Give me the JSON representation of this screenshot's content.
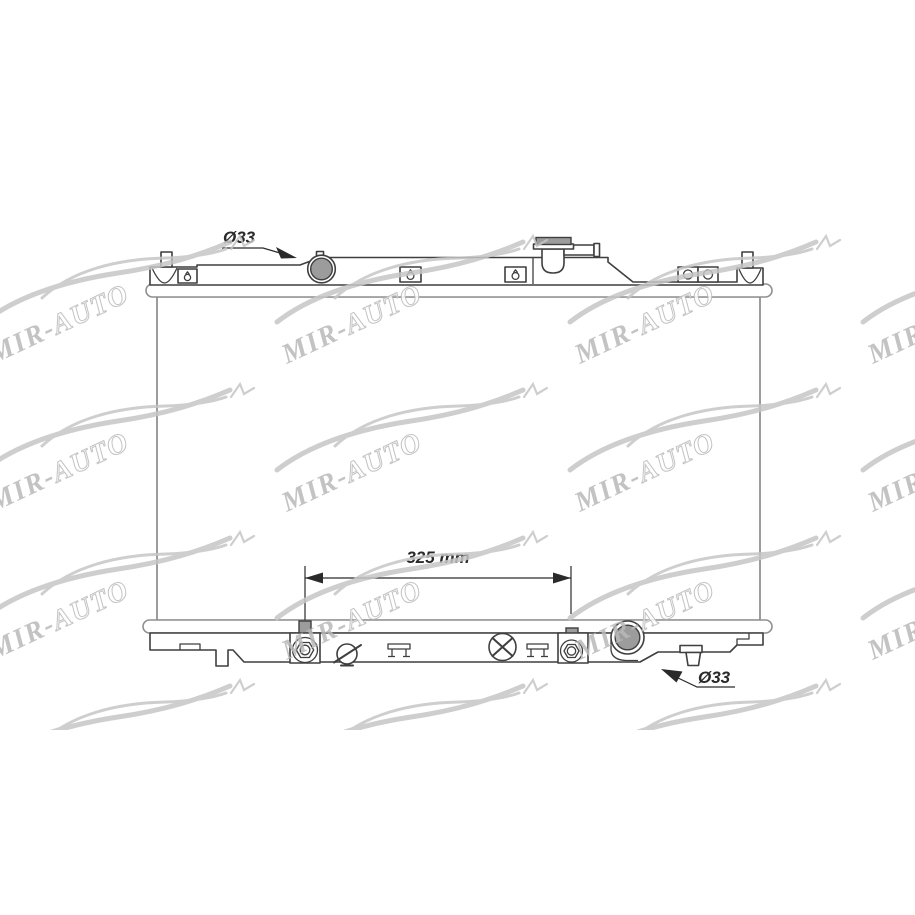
{
  "labels": {
    "inlet_diameter": "Ø33",
    "pipe_distance": "325 mm",
    "outlet_diameter": "Ø33"
  },
  "watermark": {
    "brand_first": "MIR-",
    "brand_second": "AUTO"
  },
  "colors": {
    "line": "#3f3f3f",
    "bar": "#8f8f8f",
    "core": "#5a5a5a",
    "metal": "#9c9c9c",
    "dim": "#2a2a2a",
    "wm": "#c6c6c6",
    "wmtext": "#b9b9b9",
    "bg": "#ffffff"
  }
}
